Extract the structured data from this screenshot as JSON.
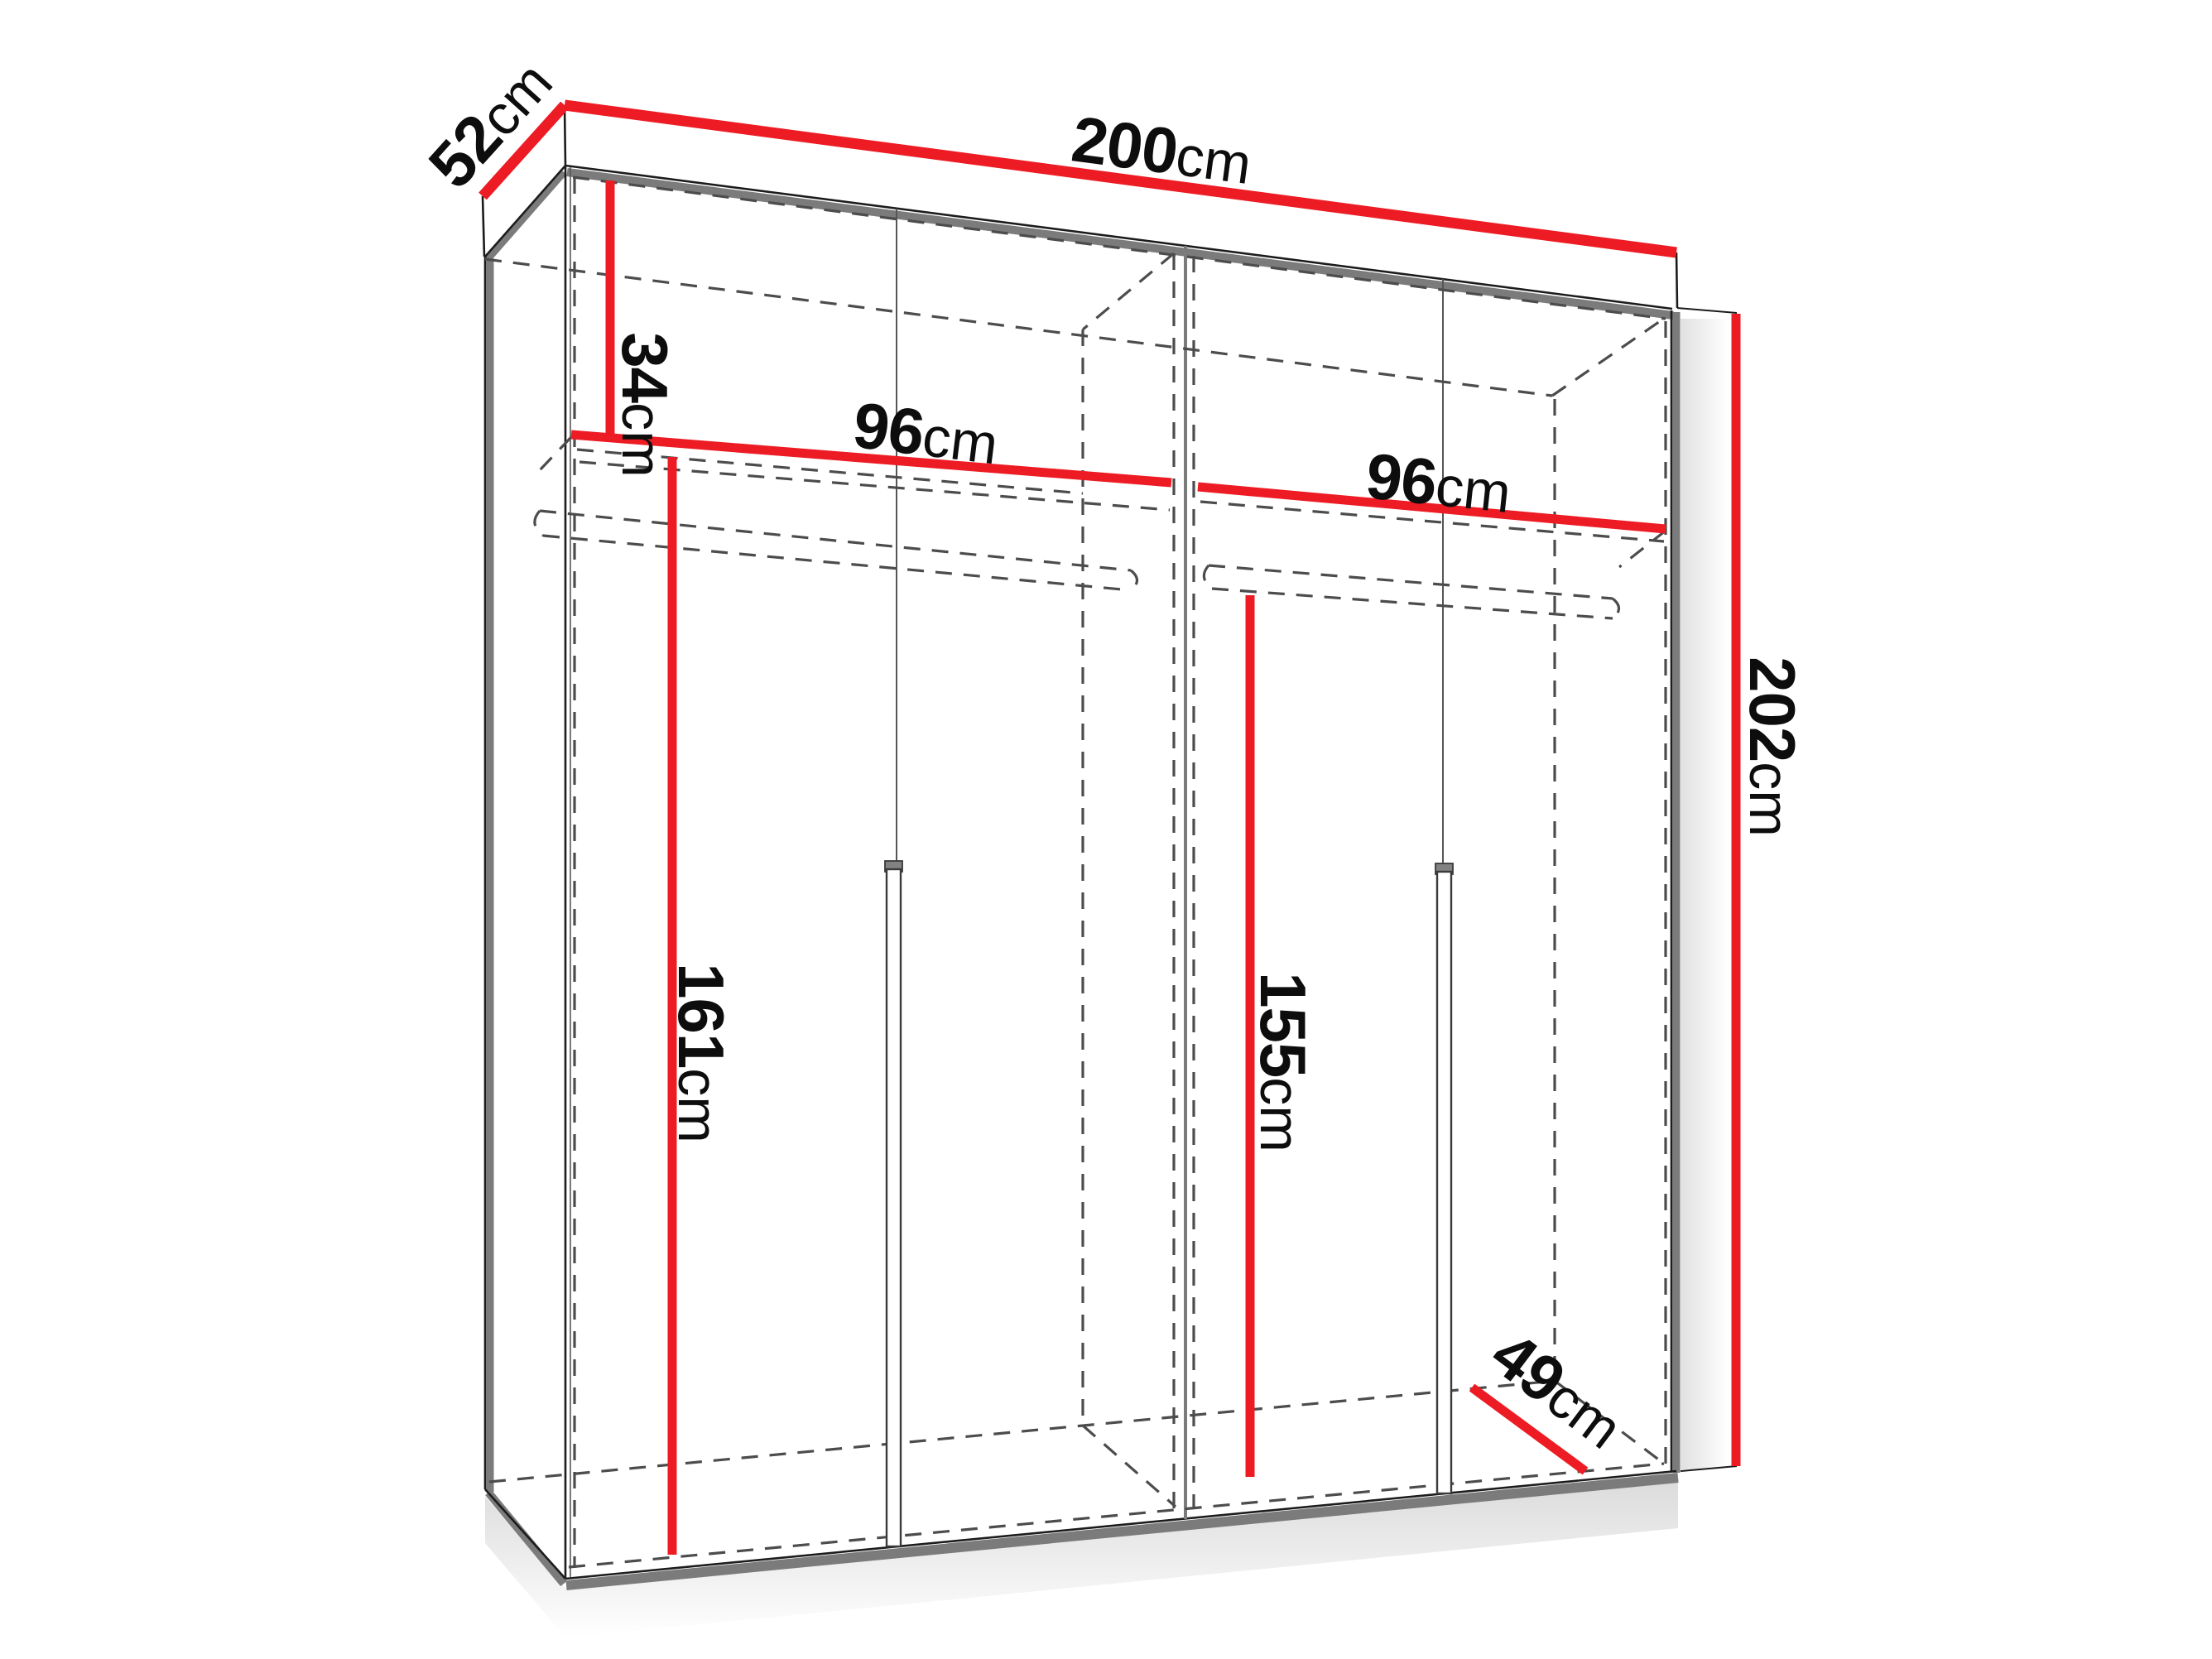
{
  "diagram": {
    "name": "wardrobe-dimension-diagram",
    "colors": {
      "dimension_line": "#ed1c24",
      "outline": "#1c1c1c",
      "shaded_edge": "#7b7b7b",
      "hidden_edge": "#4c4c4c",
      "background": "#ffffff",
      "label_text": "#0d0d0d"
    },
    "dimensions": {
      "total_width": {
        "value": "200",
        "unit": "cm"
      },
      "total_depth": {
        "value": "52",
        "unit": "cm"
      },
      "total_height": {
        "value": "202",
        "unit": "cm"
      },
      "top_section_height": {
        "value": "34",
        "unit": "cm"
      },
      "left_section_width": {
        "value": "96",
        "unit": "cm"
      },
      "right_section_width": {
        "value": "96",
        "unit": "cm"
      },
      "left_interior_height": {
        "value": "161",
        "unit": "cm"
      },
      "right_interior_height": {
        "value": "155",
        "unit": "cm"
      },
      "interior_depth": {
        "value": "49",
        "unit": "cm"
      }
    }
  }
}
